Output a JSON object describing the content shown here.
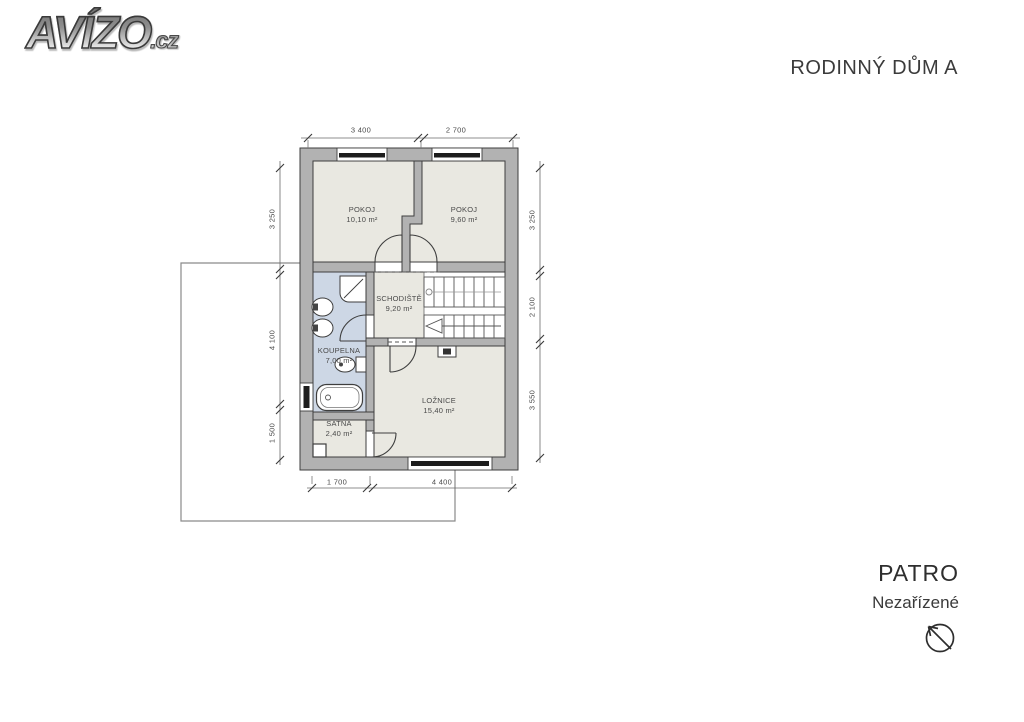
{
  "logo": {
    "brand": "AVÍZO",
    "tld": ".cz"
  },
  "header": {
    "title": "RODINNÝ DŮM A"
  },
  "plan": {
    "rooms": [
      {
        "name": "POKOJ",
        "area": "10,10 m²"
      },
      {
        "name": "POKOJ",
        "area": "9,60 m²"
      },
      {
        "name": "SCHODIŠTĚ",
        "area": "9,20 m²"
      },
      {
        "name": "KOUPELNA",
        "area": "7,00 m²"
      },
      {
        "name": "LOŽNICE",
        "area": "15,40 m²"
      },
      {
        "name": "ŠATNA",
        "area": "2,40 m²"
      }
    ],
    "dimensions": {
      "top": [
        "3 400",
        "2 700"
      ],
      "bottom": [
        "1 700",
        "4 400"
      ],
      "left": [
        "3 250",
        "4 100",
        "1 500"
      ],
      "right": [
        "3 250",
        "2 100",
        "3 550"
      ]
    }
  },
  "footer": {
    "floor": "PATRO",
    "state": "Nezařízené",
    "icon": "north-arrow-icon"
  },
  "colors": {
    "wall": "#b2b2b2",
    "floor": "#e9e8e1",
    "bathroom_floor": "#cdd7e5",
    "outline": "#3e3e3e",
    "dimension": "#4a4a4a",
    "terrace_line": "#8a8a8a"
  }
}
